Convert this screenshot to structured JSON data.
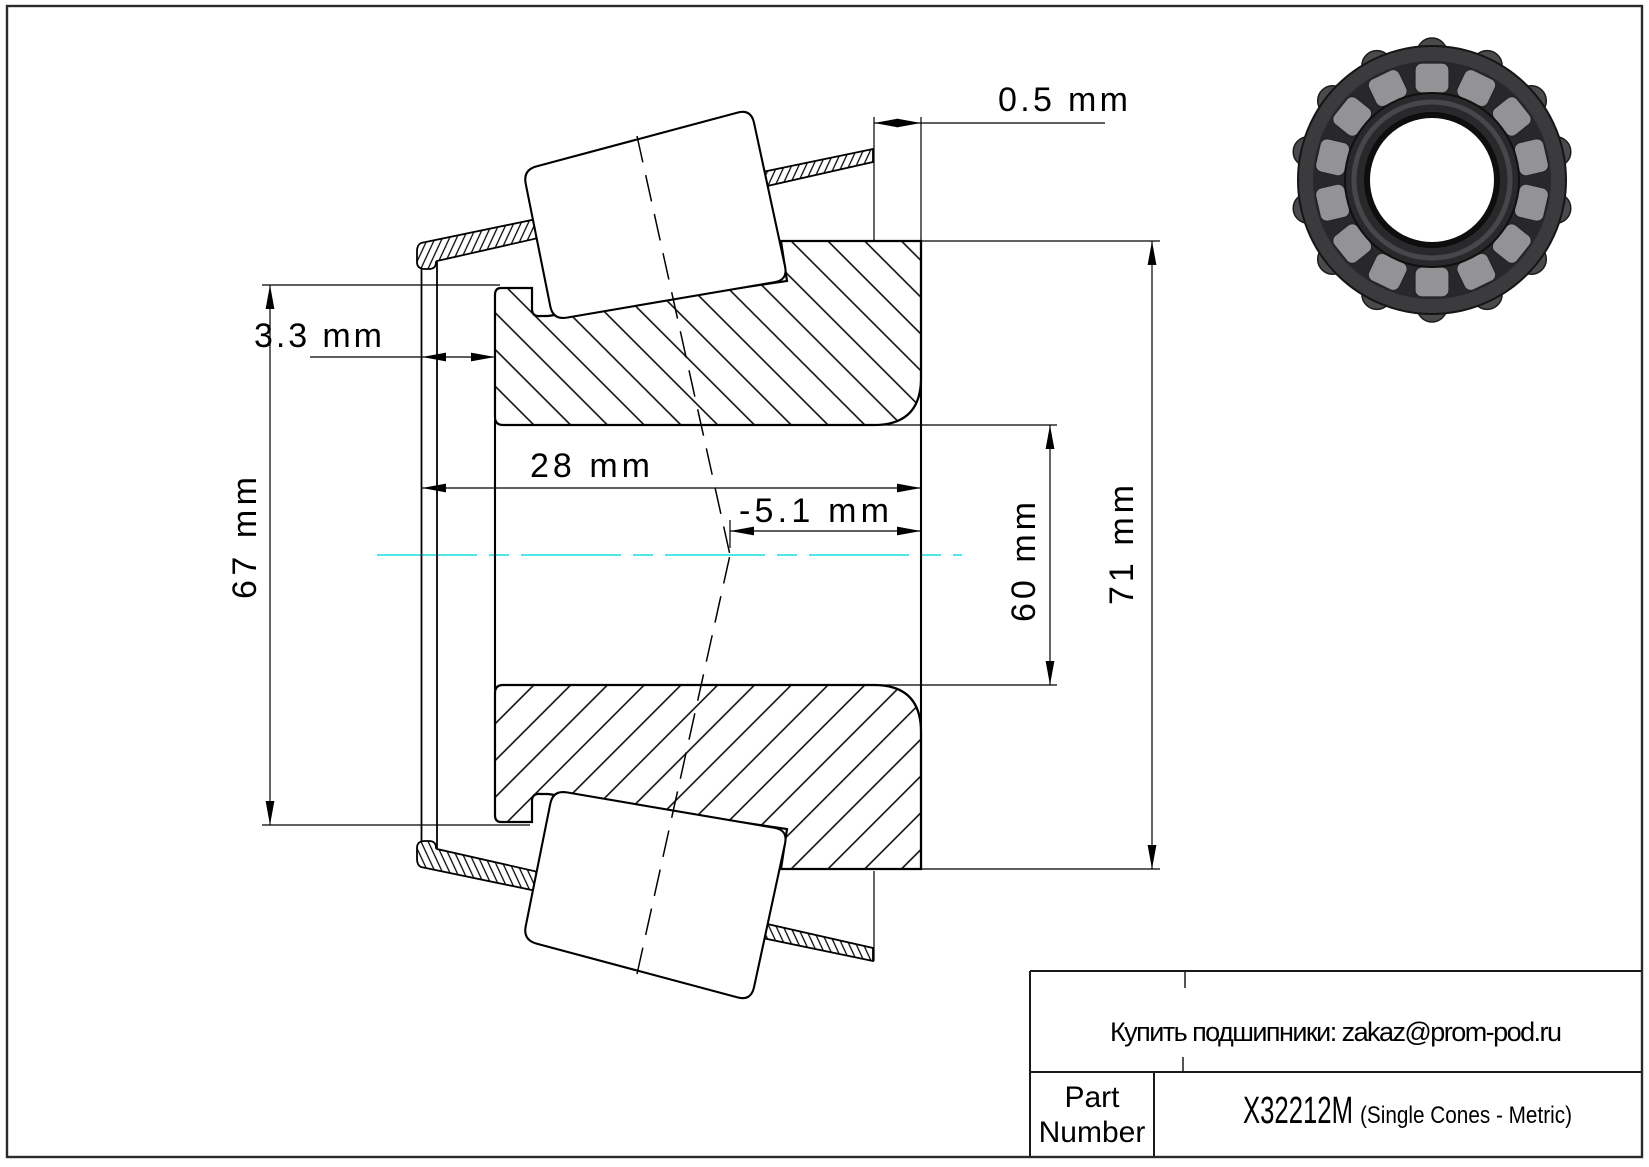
{
  "dimensions": {
    "offset_label": "0.5 mm",
    "cage_standout_label": "3.3 mm",
    "back_od_label": "67 mm",
    "width_label": "28 mm",
    "effective_center_label": "-5.1 mm",
    "bore_label": "60 mm",
    "front_od_label": "71 mm"
  },
  "title_block": {
    "contact": "Купить подшипники: zakaz@prom-pod.ru",
    "part_label_1": "Part",
    "part_label_2": "Number",
    "part_number": "X32212M",
    "part_type": "(Single Cones - Metric)"
  },
  "colors": {
    "centerline": "#35e2e2"
  }
}
